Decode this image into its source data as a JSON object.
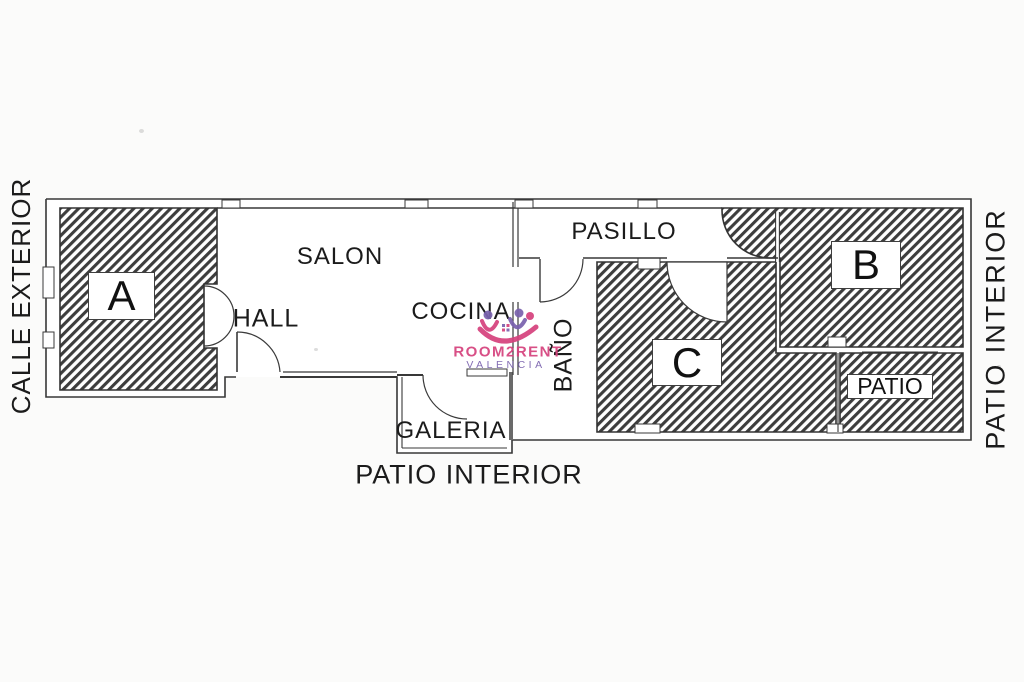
{
  "floorplan": {
    "rooms": {
      "a": "A",
      "b": "B",
      "c": "C",
      "salon": "SALON",
      "hall": "HALL",
      "cocina": "COCINA",
      "bano": "BAÑO",
      "pasillo": "PASILLO",
      "galeria": "GALERIA",
      "patio": "PATIO"
    },
    "surroundings": {
      "left": "CALLE EXTERIOR",
      "right": "PATIO INTERIOR",
      "bottom": "PATIO INTERIOR"
    },
    "watermark": {
      "brand": "ROOM2RENT",
      "city": "VALENCIA",
      "brand_color": "#d6427d",
      "city_color": "#7a62ae"
    },
    "colors": {
      "hatch": "#3d3d3d",
      "wall": "#383838",
      "paper": "#fbfbfa"
    }
  }
}
